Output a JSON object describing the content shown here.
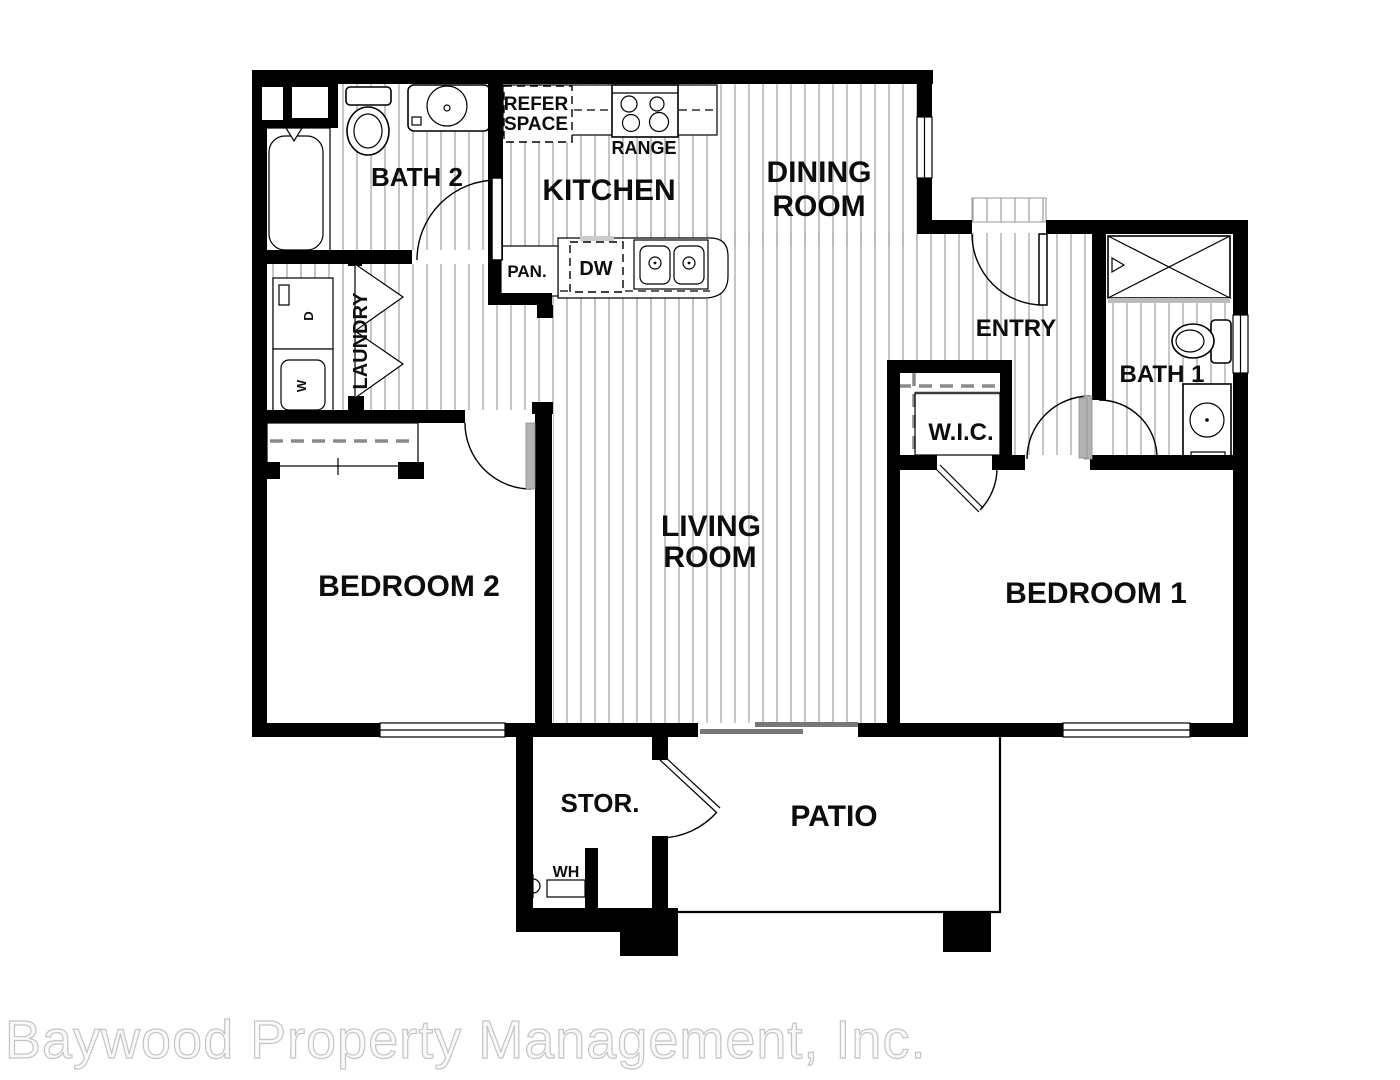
{
  "floorplan": {
    "rooms": {
      "bath2": "BATH 2",
      "kitchen": "KITCHEN",
      "dining_line1": "DINING",
      "dining_line2": "ROOM",
      "entry": "ENTRY",
      "bath1": "BATH 1",
      "wic": "W.I.C.",
      "laundry": "LAUNDRY",
      "bedroom2": "BEDROOM 2",
      "living_line1": "LIVING",
      "living_line2": "ROOM",
      "bedroom1": "BEDROOM 1",
      "storage": "STOR.",
      "patio": "PATIO"
    },
    "labels": {
      "refer_line1": "REFER",
      "refer_line2": "SPACE",
      "range": "RANGE",
      "pantry": "PAN.",
      "dishwasher": "DW",
      "water_heater": "WH",
      "dryer": "D",
      "washer": "W"
    },
    "watermark": "Baywood Property Management, Inc.",
    "colors": {
      "background": "#ffffff",
      "wall": "#000000",
      "floor_hatch": "#a6a6a6",
      "door_leaf": "#b3b3b3",
      "watermark_fill": "#fafafa",
      "watermark_stroke": "#c4c4c4"
    }
  }
}
